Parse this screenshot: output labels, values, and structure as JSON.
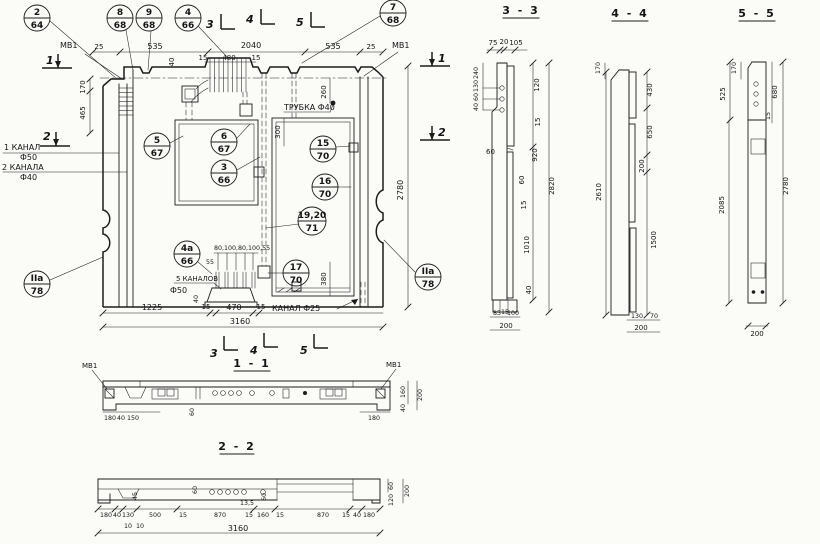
{
  "main": {
    "callouts": [
      {
        "n": "2",
        "d": "64"
      },
      {
        "n": "8",
        "d": "68"
      },
      {
        "n": "9",
        "d": "68"
      },
      {
        "n": "4",
        "d": "66"
      },
      {
        "n": "7",
        "d": "68"
      },
      {
        "n": "5",
        "d": "67"
      },
      {
        "n": "6",
        "d": "67"
      },
      {
        "n": "3",
        "d": "66"
      },
      {
        "n": "15",
        "d": "70"
      },
      {
        "n": "16",
        "d": "70"
      },
      {
        "n": "19,20",
        "d": "71"
      },
      {
        "n": "4а",
        "d": "66"
      },
      {
        "n": "17",
        "d": "70"
      },
      {
        "n": "IIа",
        "d": "78"
      },
      {
        "n": "IIа",
        "d": "78"
      }
    ],
    "markers": {
      "n1": "1",
      "n2": "2",
      "n3": "3",
      "n4": "4",
      "n5": "5"
    },
    "dims": {
      "mv1": "МВ1",
      "d25": "25",
      "d535": "535",
      "d2040": "2040",
      "d15": "15",
      "d480": "480",
      "d40": "40",
      "d170": "170",
      "d465": "465",
      "d260": "260",
      "d300": "300",
      "d380": "380",
      "d2780": "2780",
      "d1225": "1225",
      "d470": "470",
      "d3160": "3160",
      "row": "80,100,80,100,55",
      "d55": "55"
    },
    "labels": {
      "kanal1": "1 КАНАЛ",
      "f50": "Ф50",
      "kanala2": "2 КАНАЛА",
      "f40": "Ф40",
      "trubka": "ТРУБКА Ф40",
      "kanalov": "5 КАНАЛОВ",
      "kanal25": "КАНАЛ Ф25"
    }
  },
  "s11": {
    "title": "1 - 1",
    "mv1": "МВ1",
    "d180": "180",
    "d40": "40",
    "d150": "150",
    "d60": "60",
    "d160": "160",
    "d200": "200"
  },
  "s22": {
    "title": "2 - 2",
    "row": [
      "180",
      "40",
      "130",
      "500",
      "15",
      "870",
      "15",
      "160",
      "15",
      "870",
      "15",
      "40",
      "180"
    ],
    "d10": "10",
    "d3160": "3160",
    "d45": "45",
    "d60": "60",
    "d135": "13,5",
    "d120": "120",
    "d200": "200"
  },
  "s33": {
    "title": "3 - 3",
    "d75": "75",
    "d20": "20",
    "d105": "105",
    "stack": [
      "240",
      "130",
      "60",
      "40"
    ],
    "d120": "120",
    "d15": "15",
    "d920": "920",
    "d60": "60",
    "d1010": "1010",
    "d40": "40",
    "d2820": "2820",
    "d85": "85",
    "d100": "100",
    "d200": "200"
  },
  "s44": {
    "title": "4 - 4",
    "d170": "170",
    "d430": "430",
    "d650": "650",
    "d200": "200",
    "d1500": "1500",
    "d2610": "2610",
    "d130": "130",
    "d70": "70"
  },
  "s55": {
    "title": "5 - 5",
    "d170": "170",
    "d525": "525",
    "d680": "680",
    "d15": "15",
    "d2085": "2085",
    "d2780": "2780",
    "d200": "200"
  }
}
